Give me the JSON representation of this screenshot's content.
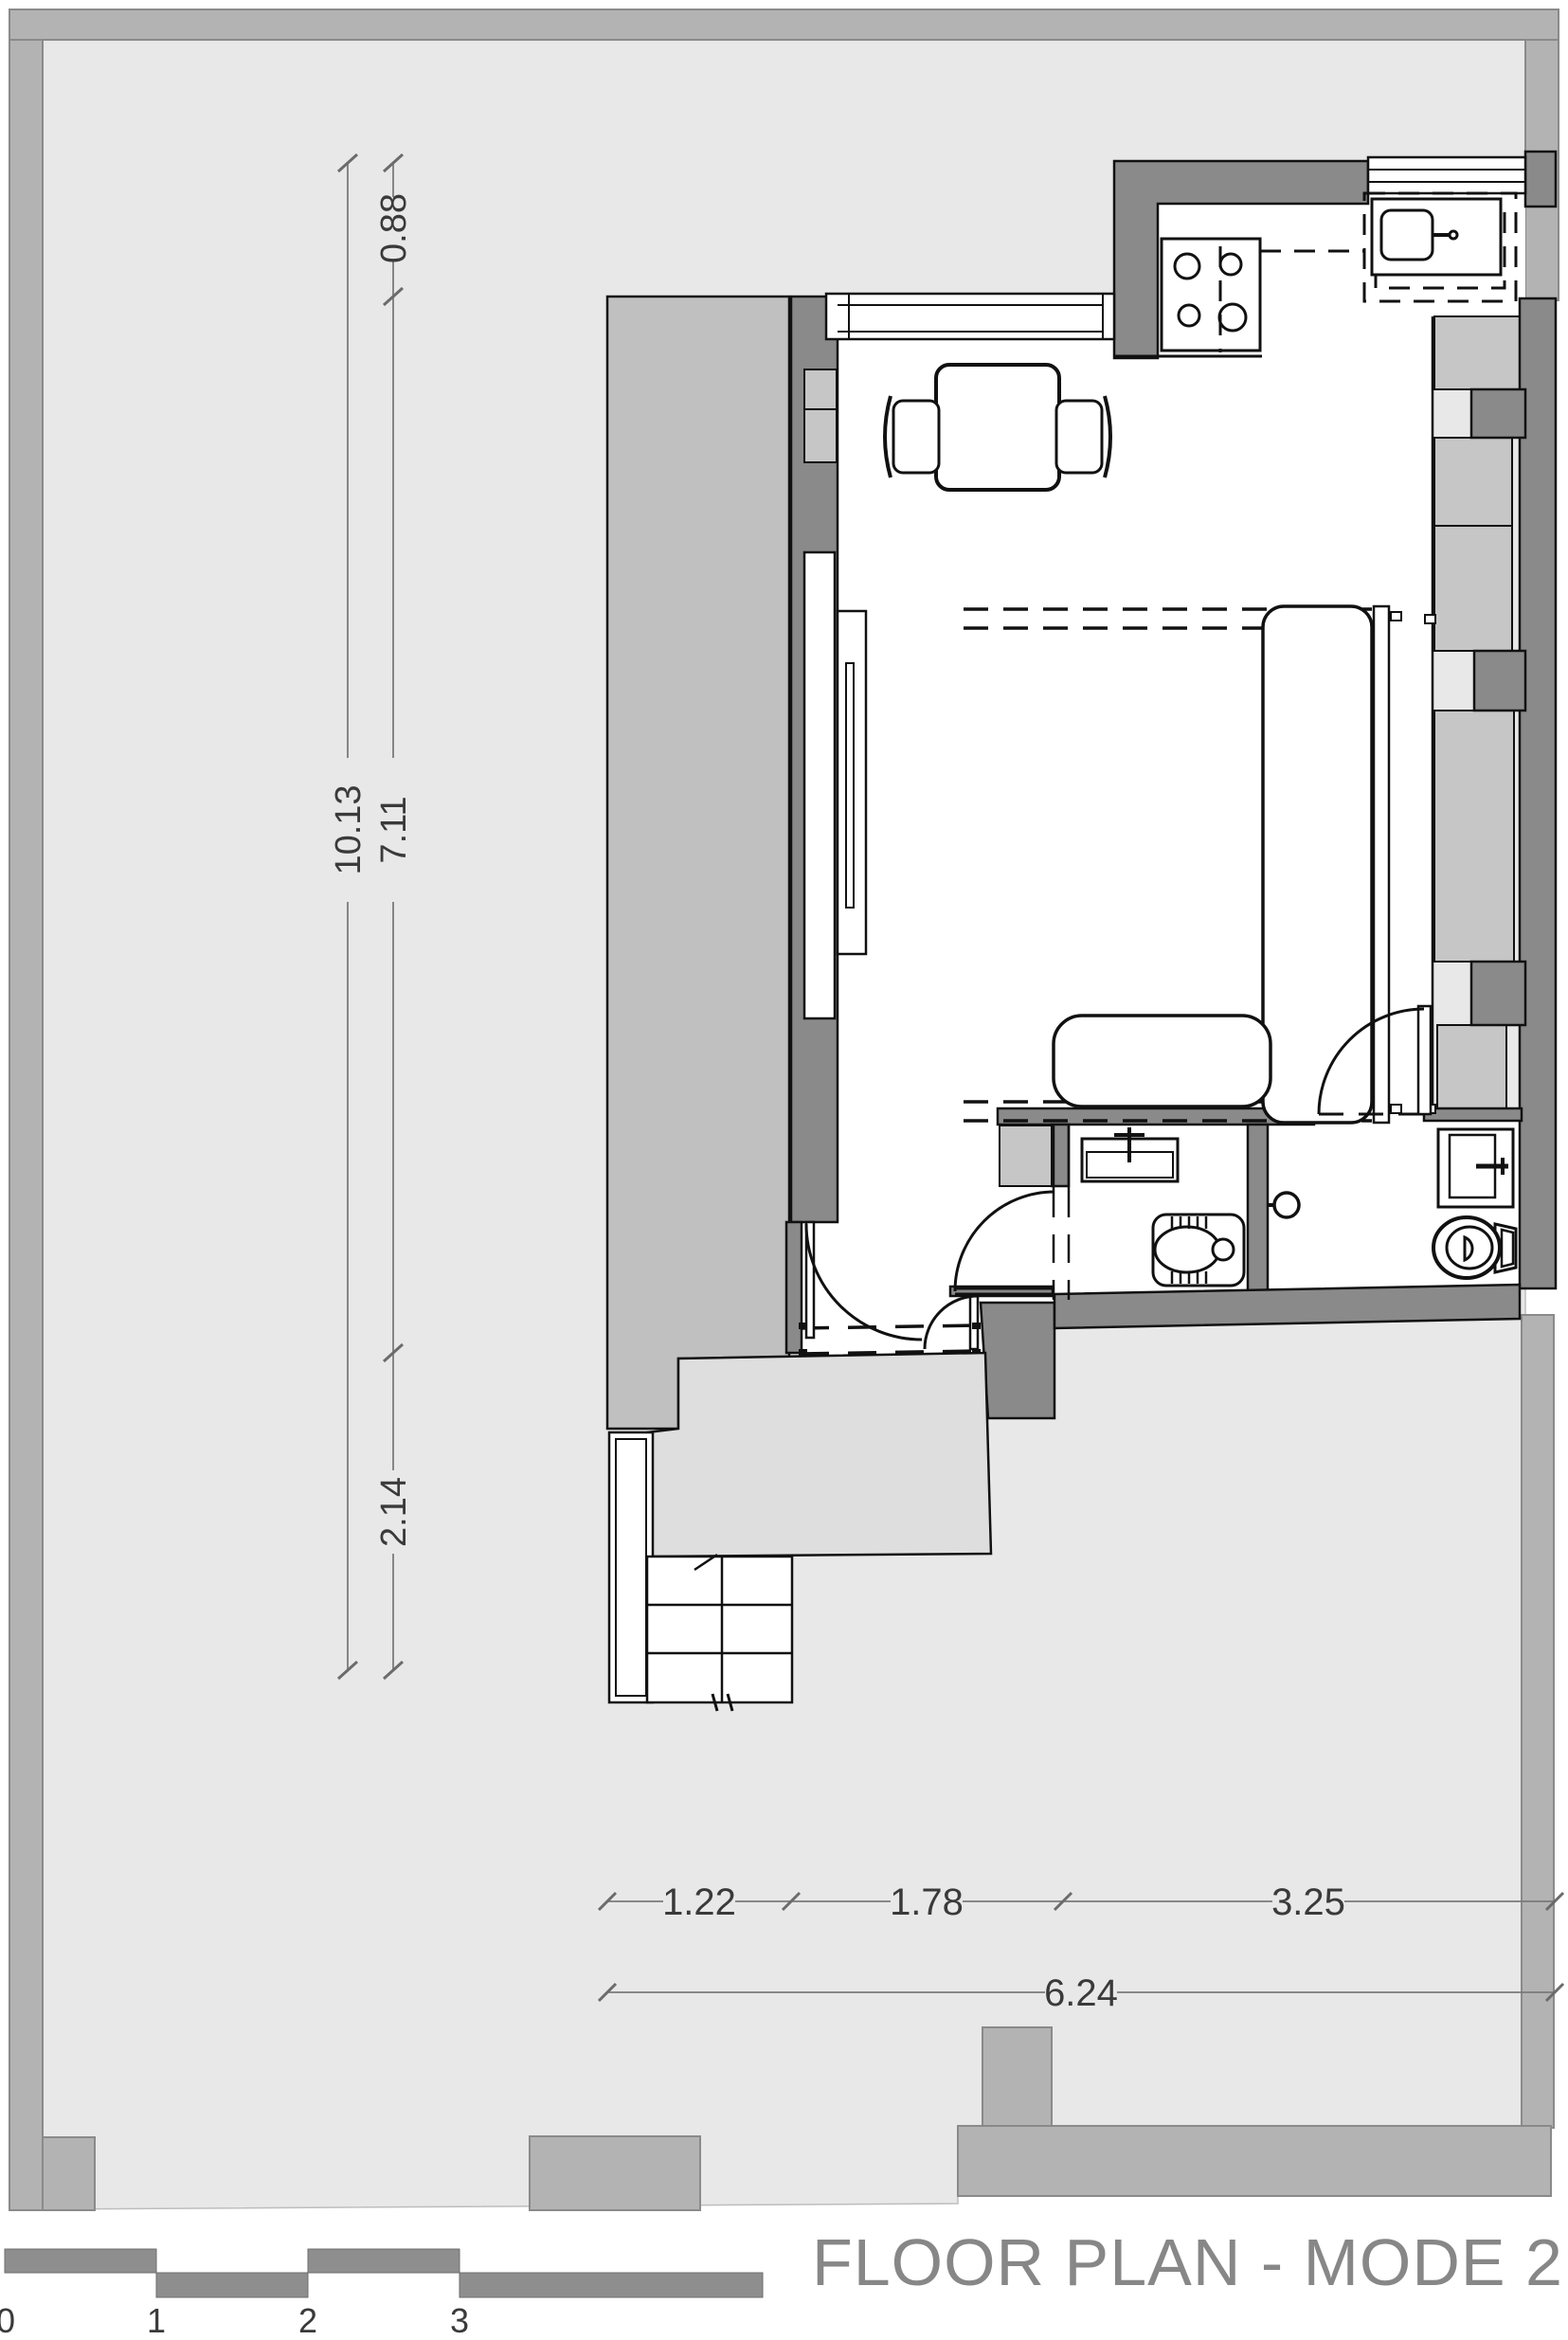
{
  "title": {
    "label": "FLOOR PLAN - MODE 2"
  },
  "dimensions": {
    "vertical": {
      "total": "10.13",
      "top": "0.88",
      "middle": "7.11",
      "bottom": "2.14"
    },
    "horizontal": {
      "seg1": "1.22",
      "seg2": "1.78",
      "seg3": "3.25",
      "total": "6.24"
    }
  },
  "scale_bar": {
    "labels": [
      "0",
      "1",
      "2",
      "3",
      "5"
    ]
  },
  "colors": {
    "site_fill": "#e8e8e8",
    "frame_band": "#b3b3b3",
    "wall_dark": "#8a8a8a",
    "neighbor_mass": "#c0c0c0",
    "niche_panel": "#c6c6c6",
    "platform": "#dedede",
    "line_black": "#111111",
    "dim_gray": "#7a7a7a",
    "title_gray": "#878787"
  }
}
